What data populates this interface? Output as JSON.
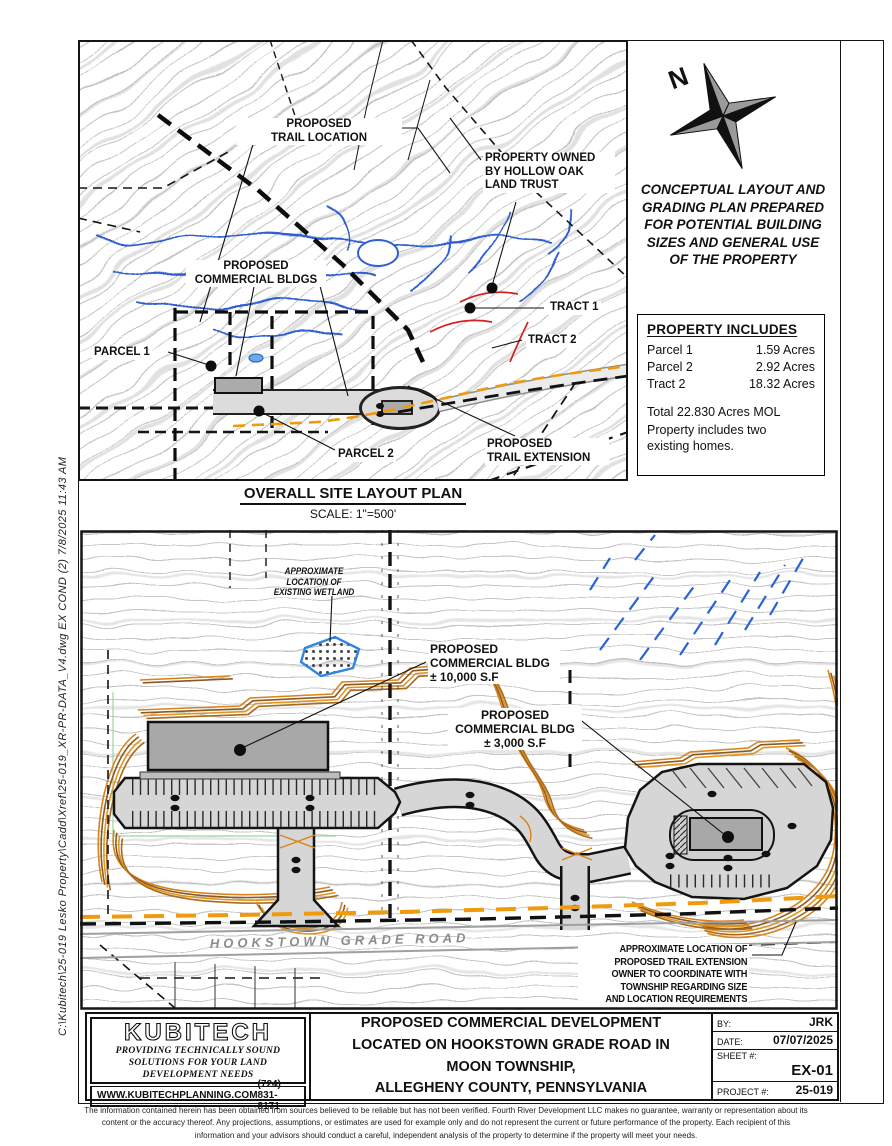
{
  "colors": {
    "contour_gray": "#c2c2c2",
    "stream_blue": "#2f5fd0",
    "grading_orange": "#d9821b",
    "grading_brown": "#8a5a22",
    "trail_orange": "#f09a0e",
    "accent_red": "#d42020",
    "ink": "#111111"
  },
  "side_note": "C:\\Kubitech\\25-019  Lesko  Property\\Cadd\\Xref\\25-019_XR-PR-DATA_V4.dwg  EX  COND  (2)  7/8/2025  11:43  AM",
  "overview_map": {
    "labels": {
      "trail_location": "PROPOSED\nTRAIL LOCATION",
      "hollow_oak": "PROPERTY OWNED\nBY HOLLOW OAK\nLAND TRUST",
      "commercial_bldgs": "PROPOSED\nCOMMERCIAL BLDGS",
      "tract1": "TRACT 1",
      "tract2": "TRACT 2",
      "parcel1": "PARCEL 1",
      "parcel2": "PARCEL 2",
      "trail_extension": "PROPOSED\nTRAIL EXTENSION"
    },
    "caption_title": "OVERALL SITE LAYOUT PLAN",
    "caption_scale": "SCALE: 1\"=500'"
  },
  "notes_panel": {
    "north": "N",
    "conceptual_note": "CONCEPTUAL LAYOUT AND\nGRADING PLAN  PREPARED\nFOR POTENTIAL BUILDING\nSIZES AND GENERAL USE\nOF THE PROPERTY",
    "property_includes": {
      "title": "PROPERTY INCLUDES",
      "rows": [
        {
          "label": "Parcel 1",
          "value": "1.59 Acres"
        },
        {
          "label": "Parcel 2",
          "value": "2.92 Acres"
        },
        {
          "label": "Tract 2",
          "value": "18.32 Acres"
        }
      ],
      "total": "Total 22.830 Acres MOL",
      "note": "Property includes two\nexisting homes."
    }
  },
  "site_plan": {
    "labels": {
      "wetland": "APPROXIMATE\nLOCATION OF\nEXISTING WETLAND",
      "bldg_large": "PROPOSED\nCOMMERCIAL BLDG\n± 10,000 S.F",
      "bldg_small": "PROPOSED\nCOMMERCIAL BLDG\n± 3,000 S.F",
      "road": "HOOKSTOWN GRADE ROAD",
      "trail_note": "APPROXIMATE LOCATION OF\nPROPOSED TRAIL EXTENSION\nOWNER TO COORDINATE WITH\nTOWNSHIP REGARDING SIZE\nAND LOCATION REQUIREMENTS"
    }
  },
  "title_block": {
    "logo": "KUBITECH",
    "tagline": "PROVIDING TECHNICALLY SOUND\nSOLUTIONS FOR YOUR LAND\nDEVELOPMENT NEEDS",
    "website": "WWW.KUBITECHPLANNING.COM",
    "phone": "(724) 831-8171",
    "project_title": "PROPOSED COMMERCIAL DEVELOPMENT\nLOCATED ON HOOKSTOWN GRADE ROAD IN\nMOON TOWNSHIP,\nALLEGHENY COUNTY, PENNSYLVANIA",
    "by_label": "BY:",
    "by_value": "JRK",
    "date_label": "DATE:",
    "date_value": "07/07/2025",
    "sheet_label": "SHEET #:",
    "sheet_value": "EX-01",
    "project_label": "PROJECT #:",
    "project_value": "25-019"
  },
  "disclaimer": "The information contained herein has been obtained from sources believed to be reliable but has not been verified. Fourth River Development LLC makes no guarantee, warranty or representation about its\ncontent or the accuracy thereof. Any projections, assumptions, or estimates are used for example only and do not represent the current or future performance of the property. Each recipient of this\ninformation and your advisors should conduct a careful, independent analysis of the property to determine if the property will meet your needs."
}
